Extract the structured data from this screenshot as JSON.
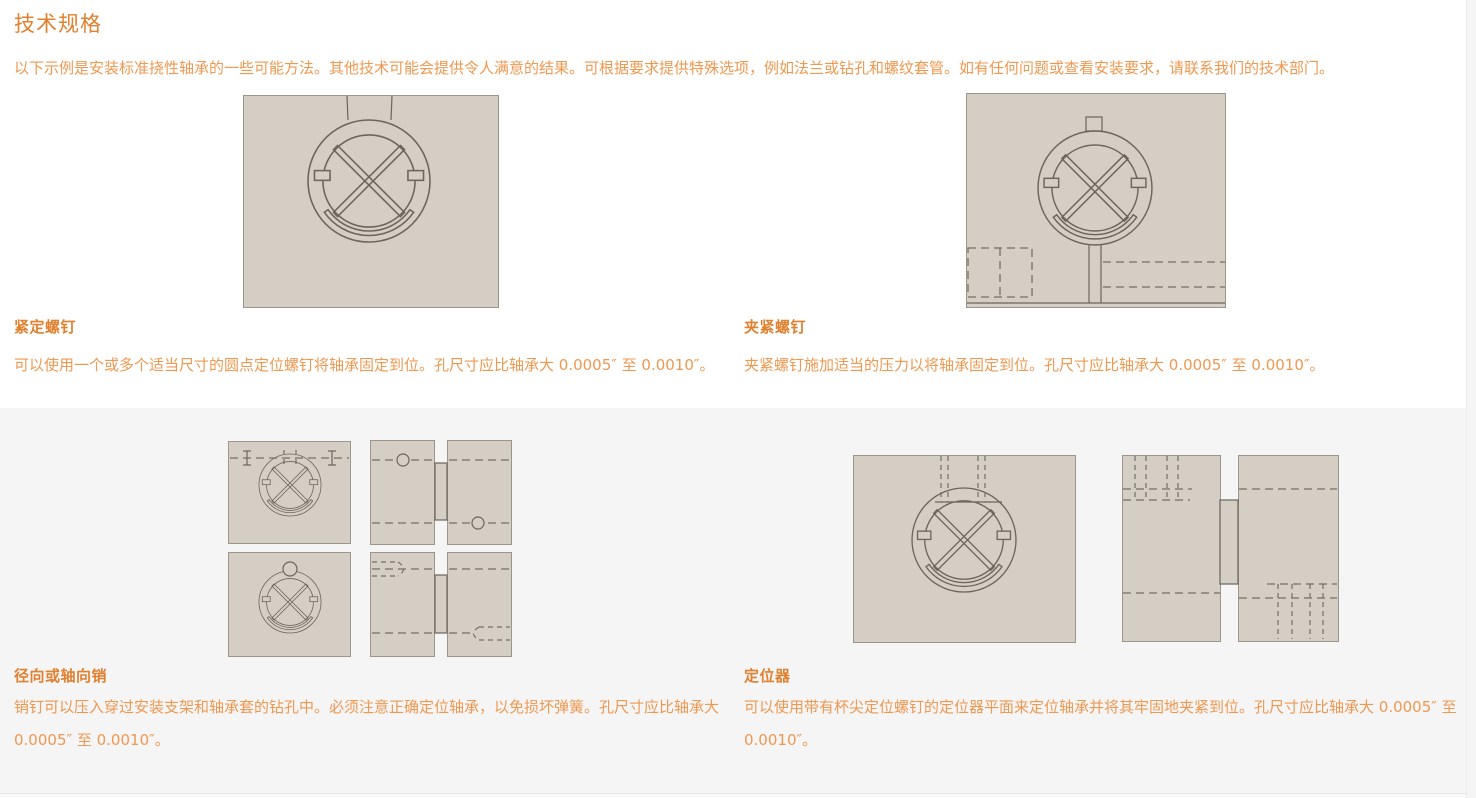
{
  "page": {
    "title": "技术规格",
    "intro": "以下示例是安装标准挠性轴承的一些可能方法。其他技术可能会提供令人满意的结果。可根据要求提供特殊选项，例如法兰或钻孔和螺纹套管。如有任何问题或查看安装要求，请联系我们的技术部门。"
  },
  "sections": [
    {
      "heading": "紧定螺钉",
      "body": "可以使用一个或多个适当尺寸的圆点定位螺钉将轴承固定到位。孔尺寸应比轴承大 0.0005″ 至 0.0010″。",
      "diagram": "set-screw-mounting-drawing"
    },
    {
      "heading": "夹紧螺钉",
      "body": "夹紧螺钉施加适当的压力以将轴承固定到位。孔尺寸应比轴承大 0.0005″ 至 0.0010″。",
      "diagram": "clamp-screw-mounting-drawing"
    },
    {
      "heading": "径向或轴向销",
      "body": "销钉可以压入穿过安装支架和轴承套的钻孔中。必须注意正确定位轴承，以免损坏弹簧。孔尺寸应比轴承大 0.0005″ 至 0.0010″。",
      "diagram": "radial-axial-pin-mounting-drawing"
    },
    {
      "heading": "定位器",
      "body": "可以使用带有杯尖定位螺钉的定位器平面来定位轴承并将其牢固地夹紧到位。孔尺寸应比轴承大 0.0005″ 至 0.0010″。",
      "diagram": "locator-mounting-drawing"
    }
  ],
  "colors": {
    "accent_heading": "#e0812f",
    "accent_text": "#ef9850",
    "diagram_fill": "#d4cec5",
    "diagram_line": "#6b655b",
    "dash_line": "#74705f",
    "panel_border": "#9b958b",
    "section_bg": "#f5f5f6"
  }
}
